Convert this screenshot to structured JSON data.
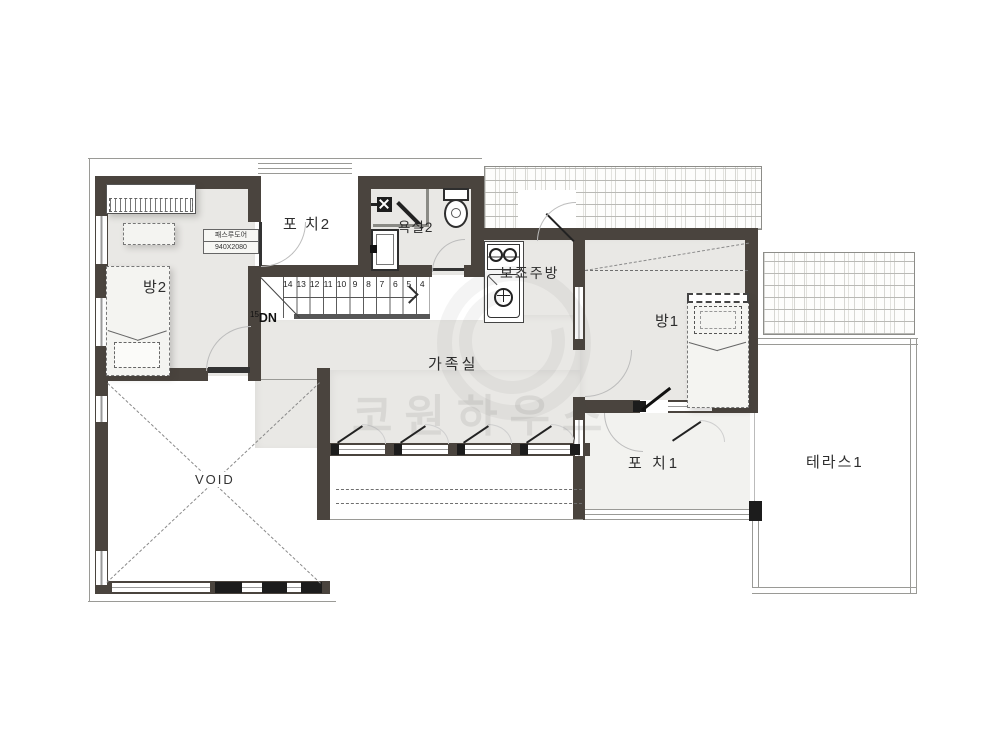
{
  "plan_title": "2F floor plan",
  "rooms": {
    "bang2": "방2",
    "porch2": "포 치2",
    "bath2": "욕실2",
    "aux_kitchen": "보조주방",
    "bang1": "방1",
    "family": "가족실",
    "void": "VOID",
    "porch1": "포 치1",
    "terrace1": "테라스1"
  },
  "door_tag": {
    "line1": "패스루도어",
    "line2": "940X2080"
  },
  "stairs": {
    "numbers": [
      "14",
      "13",
      "12",
      "11",
      "10",
      "9",
      "8",
      "7",
      "6",
      "5",
      "4"
    ],
    "landing_step": "15",
    "direction": "DN"
  },
  "watermark": {
    "brand": "코원하우스"
  },
  "colors": {
    "wall": "#4a443e",
    "room_fill": "#e9e8e5",
    "thin_line": "#9a9a96",
    "fixture_line": "#2e2e2e",
    "watermark": "rgba(70,70,70,0.10)"
  }
}
